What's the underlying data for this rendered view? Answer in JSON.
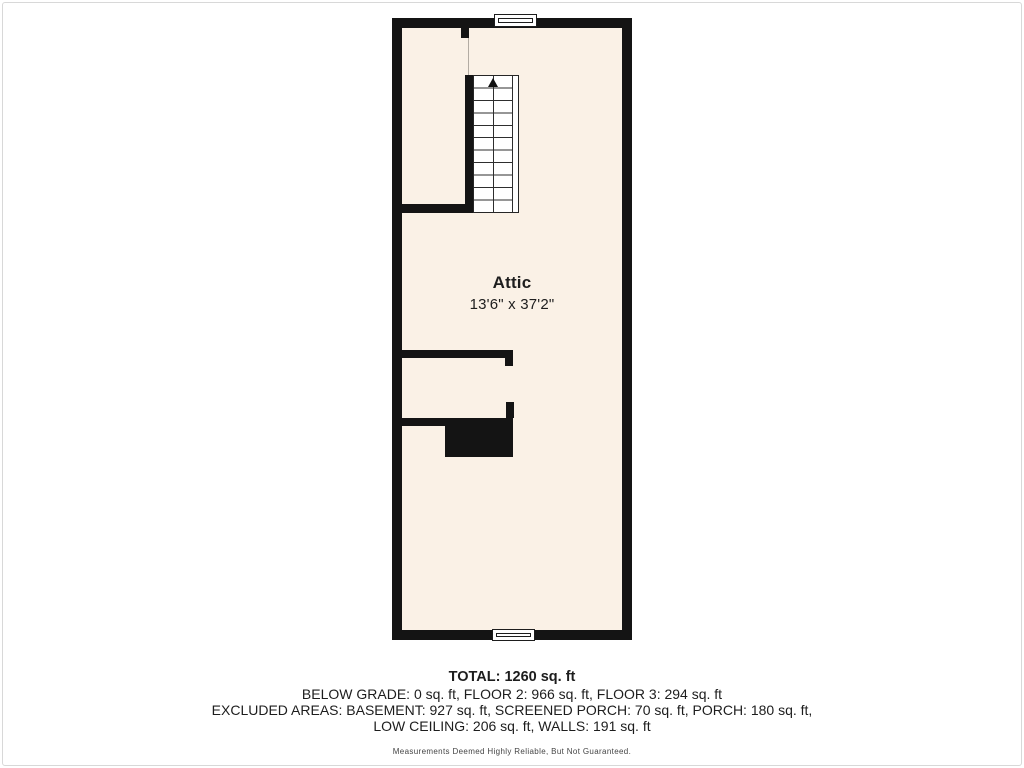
{
  "colors": {
    "wall": "#141414",
    "floor": "#FAF1E6",
    "stairline": "#2E2E2E",
    "frame": "#D8D8D8",
    "text": "#1D1D1D",
    "disclaimer": "#454545"
  },
  "floorplan": {
    "room": {
      "name": "Attic",
      "dimensions": "13'6\" x 37'2\""
    },
    "stairs": {
      "icon": "up-arrow",
      "treads": 11
    },
    "windows": [
      "top-center",
      "bottom-center"
    ]
  },
  "summary": {
    "total": "TOTAL: 1260 sq. ft",
    "lines": [
      "BELOW GRADE: 0 sq. ft, FLOOR 2: 966 sq. ft, FLOOR 3: 294 sq. ft",
      "EXCLUDED AREAS: BASEMENT: 927 sq. ft, SCREENED PORCH: 70 sq. ft, PORCH: 180 sq. ft,",
      "LOW CEILING: 206 sq. ft, WALLS: 191 sq. ft"
    ],
    "disclaimer": "Measurements Deemed Highly Reliable, But Not Guaranteed."
  }
}
